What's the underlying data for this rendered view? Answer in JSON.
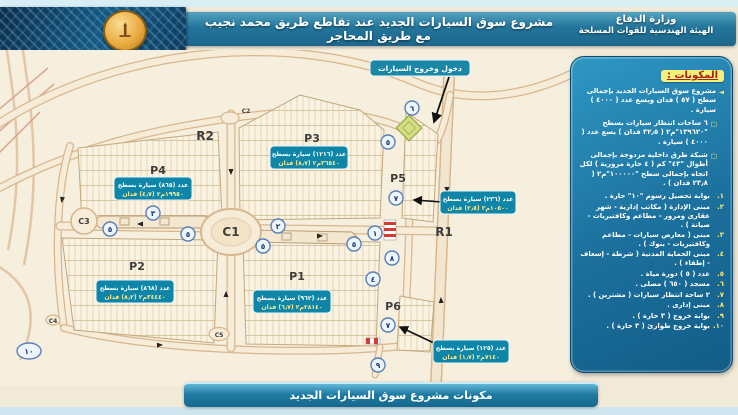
{
  "header": {
    "dept_line1": "وزارة الدفاع",
    "dept_line2": "الهيئة الهندسية للقوات المسلحة",
    "title": "مشروع سوق السيارات الجديد عند تقاطع طريق محمد نجيب مع طريق المحاجر",
    "emblem_icon": "engineering-authority-emblem"
  },
  "footer": {
    "title": "مكونات مشروع سوق السيارات الجديد"
  },
  "legend": {
    "title": "المكونات :",
    "bullets": [
      {
        "marker": "◄",
        "text": "مشروع سوق السيارات الجديد بإجمالى سطح ( ٥٧ ) فدان ويسع عدد ( ٤٠٠٠ ) سيارة ."
      },
      {
        "marker": "□",
        "text": "٦ ساحات انتظار سيارات بسطح \"١٣٩٦٢٠\"م٢ ( ٣٢٫٥ فدان ) يسع عدد ( ٤٠٠٠ ) سيارة ."
      },
      {
        "marker": "□",
        "text": "شبكة طرق داخلية مزدوجة بإجمالى أطوال \"٤٣\" كم ( ٤ حارة مرورية ) لكل اتجاه بإجمالى سطح \"١٠٠٠٠٠\"م٢ ( ٢٣٫٨ فدان ) ."
      }
    ],
    "items": [
      {
        "num": "١.",
        "text": "بوابة تحصيل رسوم \"١٠\" حارة ."
      },
      {
        "num": "٢.",
        "text": "مبنى الإدارة ( مكاتب إدارية - شهر عقارى ومرور - مطاعم وكافتيريات - صيانة ) ."
      },
      {
        "num": "٣.",
        "text": "مبنى ( معارض سيارات - مطاعم وكافتيريات - بنوك ) ."
      },
      {
        "num": "٤.",
        "text": "مبنى الحماية المدنية ( شرطة - إسعاف - إطفاء ) ."
      },
      {
        "num": "٥.",
        "text": "عدد ( ٥ ) دورة مياة ."
      },
      {
        "num": "٦.",
        "text": "مسجد ( ٦٥٠ ) مصلى ."
      },
      {
        "num": "٧.",
        "text": "٢ ساحة انتظار سيارات ( مشترين ) ."
      },
      {
        "num": "٨.",
        "text": "مبنى إدارى ."
      },
      {
        "num": "٩.",
        "text": "بوابة خروج ( ٣ حارة ) ."
      },
      {
        "num": "١٠.",
        "text": "بوابة خروج طوارئ ( ٣ حارة ) ."
      }
    ]
  },
  "map": {
    "entrance_callout": "دخول وخروج السيارات",
    "labels": {
      "r1": "R1",
      "r2": "R2",
      "p1": "P1",
      "p2": "P2",
      "p3": "P3",
      "p4": "P4",
      "p5": "P5",
      "p6": "P6",
      "c1": "C1",
      "c2": "C2",
      "c3": "C3",
      "c4": "C4",
      "c5": "C5"
    },
    "callouts": {
      "p3": {
        "line1": "عدد (١٢١٦) سيارة بسطح",
        "line2": "٣٦٥٤٠م٢ (٨٫٧) فدان"
      },
      "p4": {
        "line1": "عدد (٨٦٥) سيارة بسطح",
        "line2": "١٩٩٥٠م٢ (٤٫٧) فدان"
      },
      "p2": {
        "line1": "عدد (٨٦٨) سيارة بسطح",
        "line2": "٣٤٤٤٠م٢ (٨٫٢) فدان"
      },
      "p1": {
        "line1": "عدد (٩٦٢) سيارة بسطح",
        "line2": "٢٨١٤٠م٢ (٦٫٧) فدان"
      },
      "p5": {
        "line1": "عدد (٢٣٦) سيارة بسطح",
        "line2": "١٠٥٠٠م٢ (٢٫٥) فدان"
      },
      "p6": {
        "line1": "عدد (١٢٥) سيارة بسطح",
        "line2": "٧١٤٠م٢ (١٫٧) فدان"
      }
    },
    "markers": [
      "٦",
      "٥",
      "٧",
      "١",
      "٨",
      "٤",
      "٥",
      "٧",
      "٩",
      "٣",
      "٥",
      "٥",
      "٢",
      "٥",
      "١٠"
    ],
    "icons": {
      "green_diamond": "mosque-plaza-marker",
      "toll_gate": "toll-gate-hatch"
    }
  },
  "colors": {
    "banner_teal": "#23759b",
    "panel_blue": "#1b6f9c",
    "callout_teal": "#0f86a8",
    "map_bg": "#f6efde",
    "legend_title_bg": "#f6ef7a",
    "legend_title_red": "#a3241c",
    "highlight_yellow": "#ffe76e"
  }
}
